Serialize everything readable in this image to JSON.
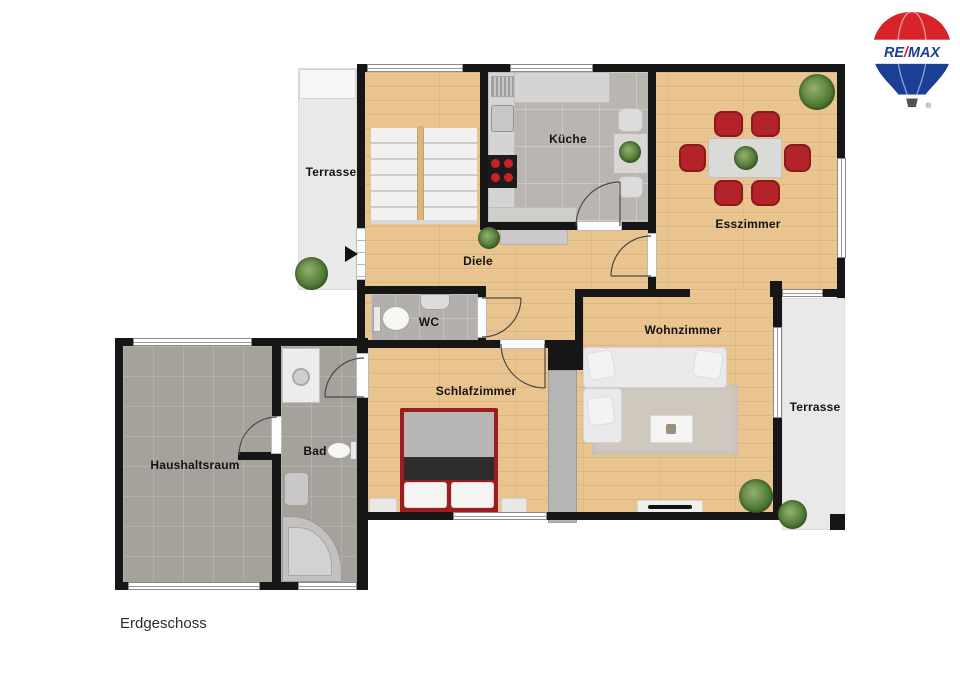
{
  "floor_label": "Erdgeschoss",
  "rooms": {
    "terrasse_left": "Terrasse",
    "kueche": "Küche",
    "esszimmer": "Esszimmer",
    "diele": "Diele",
    "wc": "WC",
    "wohnzimmer": "Wohnzimmer",
    "schlafzimmer": "Schlafzimmer",
    "bad": "Bad",
    "haushaltsraum": "Haushaltsraum",
    "terrasse_right": "Terrasse"
  },
  "logo": {
    "re": "RE",
    "slash": "/",
    "max": "MAX",
    "registered": "®"
  },
  "colors": {
    "wall": "#161616",
    "wood_floor": "#e9c48f",
    "kitchen_tile": "#b9b6b2",
    "dark_tile": "#a5a19b",
    "terrace": "#e9e9e9",
    "chair_red": "#b2242a",
    "bed_red": "#9e1b20",
    "logo_red": "#d8232a",
    "logo_blue": "#1b3f94"
  }
}
